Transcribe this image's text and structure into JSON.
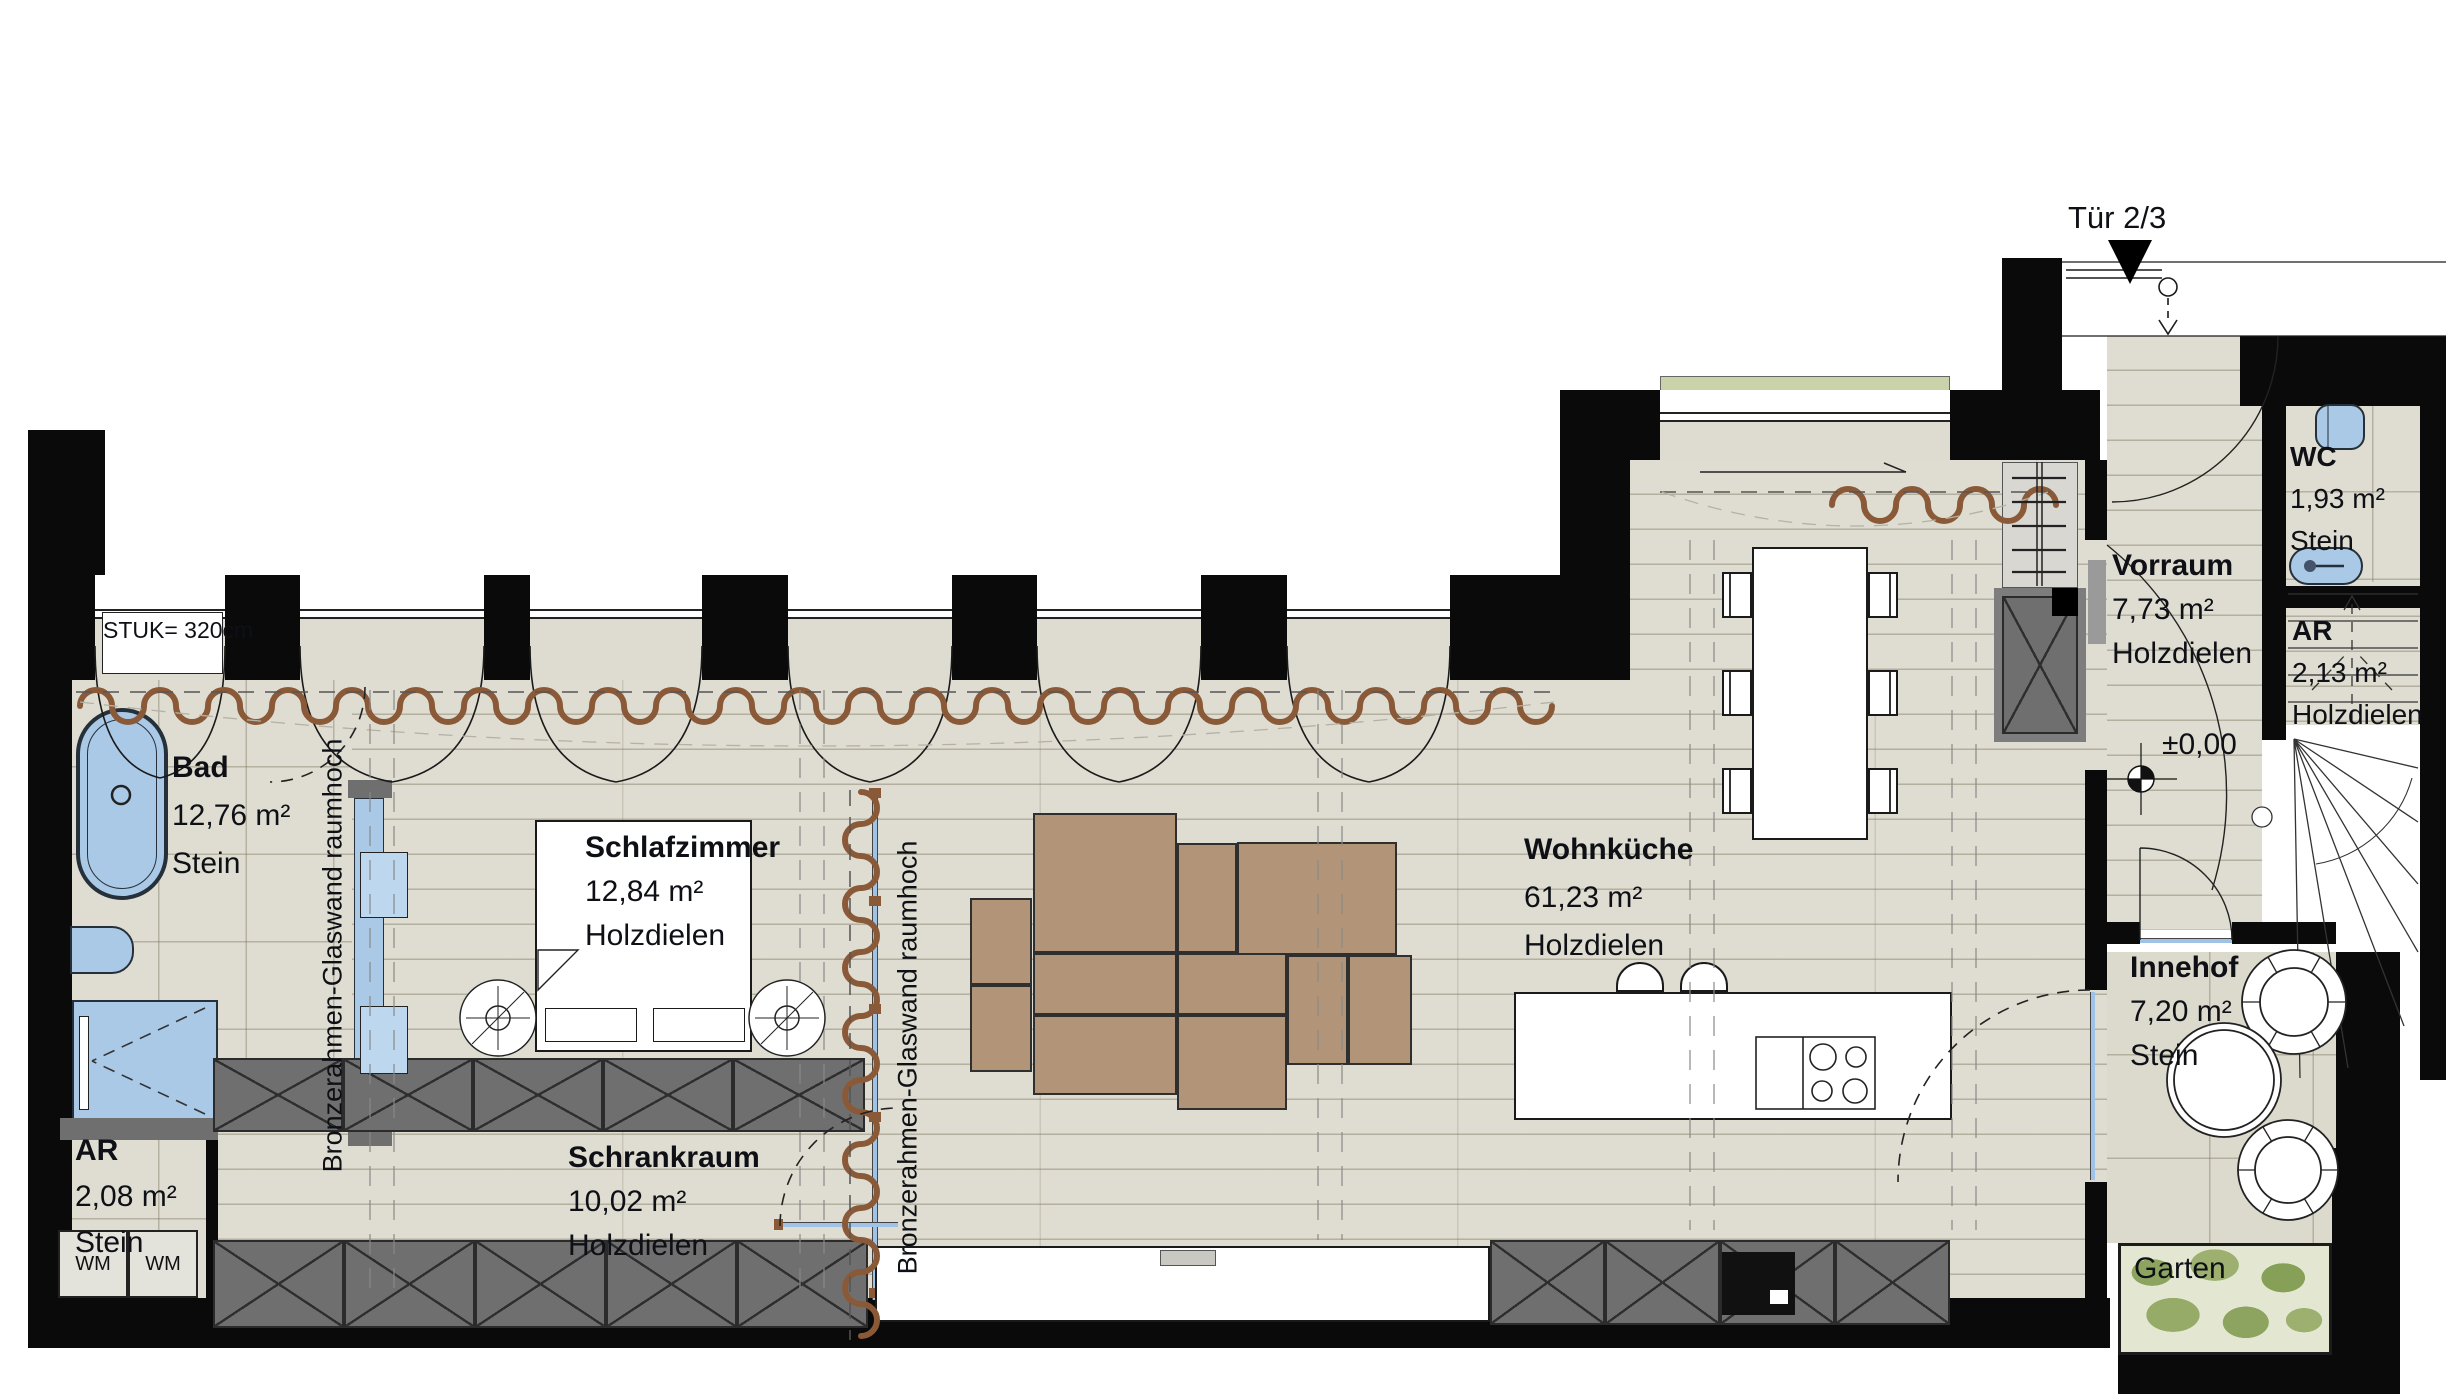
{
  "labels": {
    "door": "Tür 2/3",
    "level": "±0,00",
    "ceiling_note_line1": "STUK=",
    "ceiling_note_line2": "320cm",
    "glass_wall": "Bronzerahmen-Glaswand raumhoch",
    "washing_machine": "WM"
  },
  "rooms": {
    "bad": {
      "name": "Bad",
      "area": "12,76 m²",
      "floor": "Stein"
    },
    "ar_left": {
      "name": "AR",
      "area": "2,08 m²",
      "floor": "Stein"
    },
    "schlafzimmer": {
      "name": "Schlafzimmer",
      "area": "12,84 m²",
      "floor": "Holzdielen"
    },
    "schrankraum": {
      "name": "Schrankraum",
      "area": "10,02 m²",
      "floor": "Holzdielen"
    },
    "wohnkueche": {
      "name": "Wohnküche",
      "area": "61,23 m²",
      "floor": "Holzdielen"
    },
    "vorraum": {
      "name": "Vorraum",
      "area": "7,73 m²",
      "floor": "Holzdielen"
    },
    "wc": {
      "name": "WC",
      "area": "1,93 m²",
      "floor": "Stein"
    },
    "ar_right": {
      "name": "AR",
      "area": "2,13 m²",
      "floor": "Holzdielen"
    },
    "innehof": {
      "name": "Innehof",
      "area": "7,20 m²",
      "floor": "Stein"
    },
    "garten": {
      "name": "Garten"
    }
  },
  "colors": {
    "wall": "#0a0a0a",
    "floor": "#dfddd1",
    "fixture_blue": "#aac9e6",
    "furniture_gray": "#6f6f6f",
    "sofa_brown": "#b29478",
    "curtain_brown": "#8a5a38",
    "garden_green": "#e3e7d2"
  }
}
